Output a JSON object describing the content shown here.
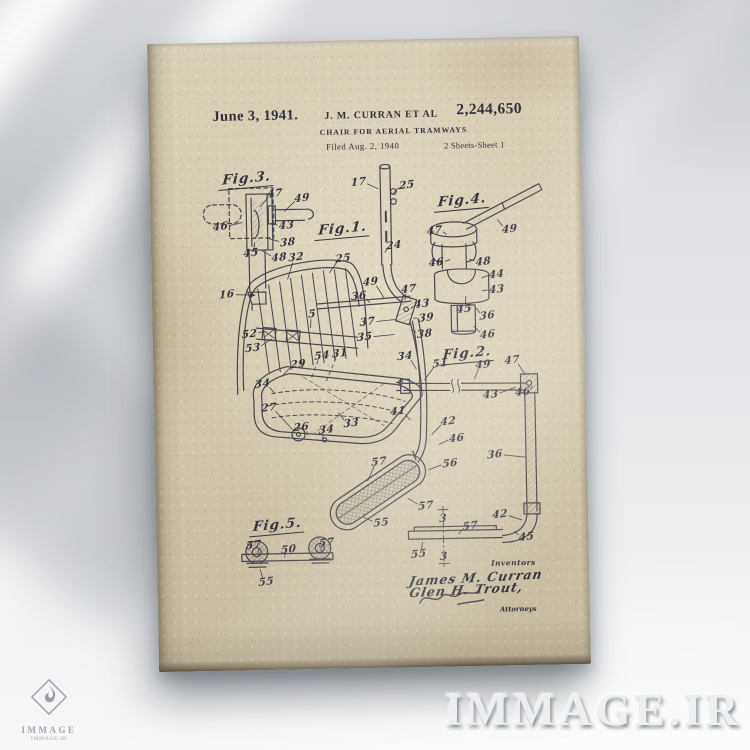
{
  "colors": {
    "wall": "#e3e5e8",
    "paper": "#d3c8ae",
    "ink": "#34343f",
    "shadow": "#5a6068"
  },
  "patent": {
    "date": "June 3, 1941.",
    "inventors_line": "J. M. CURRAN ET AL",
    "number": "2,244,650",
    "title": "CHAIR FOR AERIAL TRAMWAYS",
    "filed_line": "Filed Aug. 2, 1940",
    "sheet_line": "2 Sheets-Sheet 1",
    "signature_block": {
      "inventors_label": "Inventors",
      "inventor_1": "James M. Curran",
      "inventor_2": "Glen H. Trout,",
      "attorneys_label": "Attorneys"
    }
  },
  "drawing": {
    "ink_color": "#3a3a46",
    "fig_labels": [
      {
        "t": "Fig.3.",
        "x": 97,
        "y": 138
      },
      {
        "t": "Fig.1.",
        "x": 192,
        "y": 190
      },
      {
        "t": "Fig.4.",
        "x": 312,
        "y": 164
      },
      {
        "t": "Fig.2.",
        "x": 314,
        "y": 317
      },
      {
        "t": "Fig.5.",
        "x": 121,
        "y": 485
      }
    ],
    "ref_labels": [
      {
        "t": "47",
        "x": 125,
        "y": 152,
        "lx": 110,
        "ly": 165
      },
      {
        "t": "49",
        "x": 152,
        "y": 157,
        "lx": 134,
        "ly": 170
      },
      {
        "t": "46",
        "x": 70,
        "y": 184,
        "lx": 92,
        "ly": 180
      },
      {
        "t": "43",
        "x": 136,
        "y": 184,
        "lx": 120,
        "ly": 182
      },
      {
        "t": "38",
        "x": 137,
        "y": 201,
        "lx": 116,
        "ly": 196
      },
      {
        "t": "45",
        "x": 100,
        "y": 211,
        "lx": 104,
        "ly": 200
      },
      {
        "t": "48",
        "x": 128,
        "y": 216,
        "lx": 110,
        "ly": 208
      },
      {
        "t": "17",
        "x": 209,
        "y": 142,
        "lx": 228,
        "ly": 149
      },
      {
        "t": "25",
        "x": 257,
        "y": 146,
        "lx": 243,
        "ly": 154
      },
      {
        "t": "24",
        "x": 243,
        "y": 206,
        "lx": 234,
        "ly": 213
      },
      {
        "t": "16",
        "x": 75,
        "y": 252,
        "lx": 103,
        "ly": 253,
        "ar": 1
      },
      {
        "t": "32",
        "x": 145,
        "y": 216,
        "lx": 136,
        "ly": 238
      },
      {
        "t": "25",
        "x": 192,
        "y": 218,
        "lx": 178,
        "ly": 232
      },
      {
        "t": "49",
        "x": 219,
        "y": 242,
        "lx": 232,
        "ly": 258
      },
      {
        "t": "36",
        "x": 207,
        "y": 256,
        "lx": 218,
        "ly": 263
      },
      {
        "t": "47",
        "x": 257,
        "y": 250,
        "lx": 253,
        "ly": 261
      },
      {
        "t": "43",
        "x": 270,
        "y": 265,
        "lx": 259,
        "ly": 269
      },
      {
        "t": "39",
        "x": 274,
        "y": 279,
        "lx": 261,
        "ly": 279
      },
      {
        "t": "38",
        "x": 272,
        "y": 295,
        "lx": 259,
        "ly": 290
      },
      {
        "t": "37",
        "x": 215,
        "y": 282,
        "lx": 243,
        "ly": 280
      },
      {
        "t": "35",
        "x": 212,
        "y": 297,
        "lx": 242,
        "ly": 295
      },
      {
        "t": "34",
        "x": 252,
        "y": 317,
        "lx": 263,
        "ly": 330
      },
      {
        "t": "52",
        "x": 97,
        "y": 292,
        "lx": 112,
        "ly": 289
      },
      {
        "t": "53",
        "x": 100,
        "y": 306,
        "lx": 119,
        "ly": 297
      },
      {
        "t": "5",
        "x": 160,
        "y": 273,
        "lx": 158,
        "ly": 287
      },
      {
        "t": "29",
        "x": 145,
        "y": 323,
        "lx": 130,
        "ly": 333
      },
      {
        "t": "54",
        "x": 169,
        "y": 315,
        "lx": 158,
        "ly": 337,
        "d": 1
      },
      {
        "t": "31",
        "x": 187,
        "y": 313,
        "lx": 172,
        "ly": 342,
        "d": 1
      },
      {
        "t": "34",
        "x": 109,
        "y": 342,
        "lx": 121,
        "ly": 352
      },
      {
        "t": "27",
        "x": 115,
        "y": 366,
        "lx": 138,
        "ly": 388
      },
      {
        "t": "26",
        "x": 147,
        "y": 386,
        "lx": 153,
        "ly": 394
      },
      {
        "t": "34",
        "x": 172,
        "y": 389,
        "lx": 168,
        "ly": 399
      },
      {
        "t": "33",
        "x": 197,
        "y": 383,
        "lx": 184,
        "ly": 372
      },
      {
        "t": "41",
        "x": 244,
        "y": 372,
        "lx": 256,
        "ly": 381
      },
      {
        "t": "57",
        "x": 224,
        "y": 422,
        "lx": 212,
        "ly": 441
      },
      {
        "t": "56",
        "x": 295,
        "y": 425,
        "lx": 273,
        "ly": 431
      },
      {
        "t": "57",
        "x": 270,
        "y": 467,
        "lx": 252,
        "ly": 459
      },
      {
        "t": "55",
        "x": 225,
        "y": 483,
        "lx": 207,
        "ly": 477
      },
      {
        "t": "47",
        "x": 284,
        "y": 192,
        "lx": 296,
        "ly": 196
      },
      {
        "t": "49",
        "x": 359,
        "y": 192,
        "lx": 347,
        "ly": 182
      },
      {
        "t": "46",
        "x": 285,
        "y": 224,
        "lx": 299,
        "ly": 221
      },
      {
        "t": "48",
        "x": 332,
        "y": 224,
        "lx": 318,
        "ly": 221
      },
      {
        "t": "44",
        "x": 345,
        "y": 237,
        "lx": 330,
        "ly": 240
      },
      {
        "t": "43",
        "x": 345,
        "y": 252,
        "lx": 330,
        "ly": 253
      },
      {
        "t": "45",
        "x": 312,
        "y": 271,
        "lx": 314,
        "ly": 258
      },
      {
        "t": "36",
        "x": 335,
        "y": 278,
        "lx": 324,
        "ly": 270
      },
      {
        "t": "46",
        "x": 335,
        "y": 297,
        "lx": 321,
        "ly": 288
      },
      {
        "t": "51",
        "x": 287,
        "y": 325,
        "lx": 271,
        "ly": 341
      },
      {
        "t": "49",
        "x": 330,
        "y": 327,
        "lx": 321,
        "ly": 341
      },
      {
        "t": "47",
        "x": 359,
        "y": 323,
        "lx": 372,
        "ly": 338
      },
      {
        "t": "43",
        "x": 337,
        "y": 357,
        "lx": 362,
        "ly": 350
      },
      {
        "t": "46",
        "x": 369,
        "y": 355,
        "lx": 379,
        "ly": 349
      },
      {
        "t": "42",
        "x": 294,
        "y": 383,
        "lx": 277,
        "ly": 396
      },
      {
        "t": "46",
        "x": 302,
        "y": 400,
        "lx": 284,
        "ly": 406
      },
      {
        "t": "36",
        "x": 340,
        "y": 417,
        "lx": 370,
        "ly": 420
      },
      {
        "t": "42",
        "x": 344,
        "y": 477,
        "lx": 366,
        "ly": 483
      },
      {
        "t": "45",
        "x": 370,
        "y": 500,
        "lx": 358,
        "ly": 494
      },
      {
        "t": "3",
        "x": 287,
        "y": 480
      },
      {
        "t": "57",
        "x": 314,
        "y": 488,
        "lx": 302,
        "ly": 496
      },
      {
        "t": "55",
        "x": 262,
        "y": 515,
        "lx": 266,
        "ly": 503
      },
      {
        "t": "3",
        "x": 287,
        "y": 518
      },
      {
        "t": "57",
        "x": 97,
        "y": 503,
        "lx": 102,
        "ly": 511
      },
      {
        "t": "50",
        "x": 132,
        "y": 508,
        "lx": 128,
        "ly": 516
      },
      {
        "t": "57",
        "x": 170,
        "y": 502,
        "lx": 164,
        "ly": 510
      },
      {
        "t": "55",
        "x": 109,
        "y": 540,
        "lx": 103,
        "ly": 527
      }
    ]
  },
  "watermark": {
    "site_text": "IMMAGE.IR",
    "logo_text": "IMMAGE",
    "logo_subtext": "IMMAGE.IR"
  }
}
